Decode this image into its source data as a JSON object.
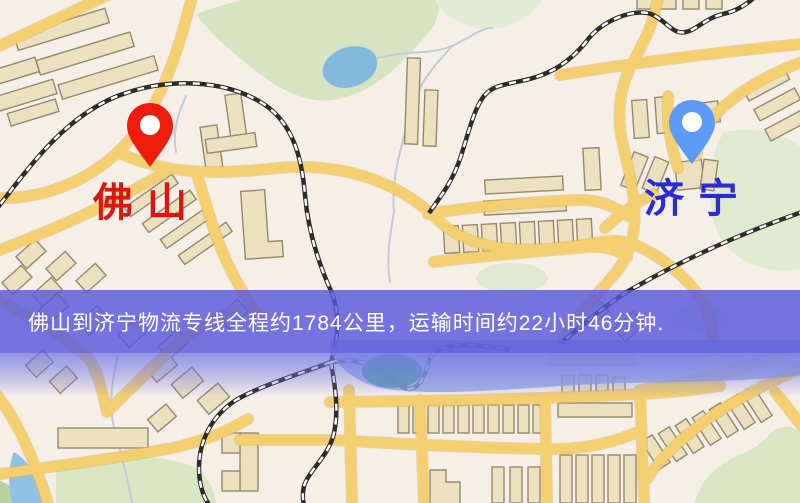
{
  "map": {
    "origin": {
      "label": "佛山",
      "pin_color": "#EE1C0C",
      "label_color": "#DD1512"
    },
    "destination": {
      "label": "济宁",
      "pin_color": "#5B9BF5",
      "label_color": "#2B2BD5"
    },
    "banner": {
      "text": "佛山到济宁物流专线全程约1784公里，运输时间约22小时46分钟.",
      "bg_color": "#5858DE",
      "text_color": "#FFFFFF"
    },
    "route": {
      "distance_km": "1784",
      "duration": "22小时46分钟"
    },
    "colors": {
      "background": "#F6EFE8",
      "road": "#F3CF6F",
      "road_casing": "#E2B754",
      "building_fill": "#EBE1C1",
      "building_stroke": "#95896C",
      "park_green": "#D7E4C2",
      "water_blue": "#84B9DE",
      "river_blue": "#93A6E3",
      "rail_dark": "#2E2C29"
    }
  }
}
